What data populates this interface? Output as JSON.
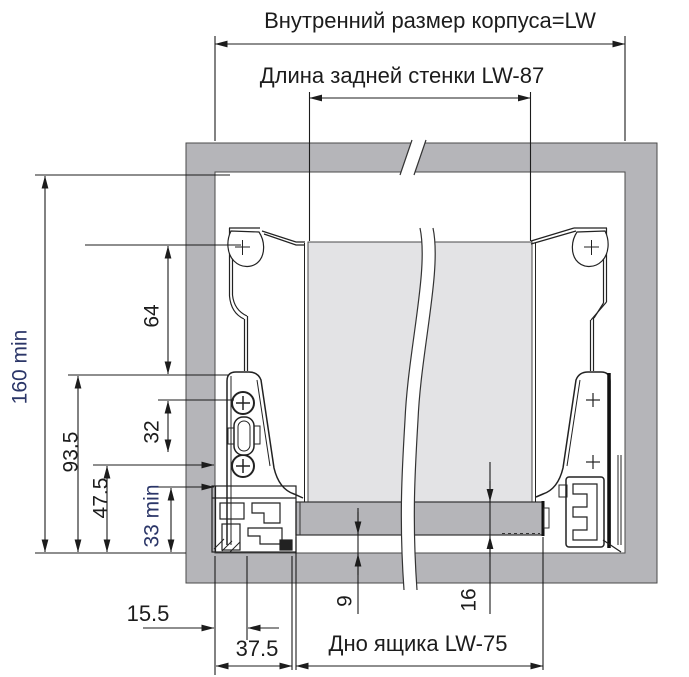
{
  "drawing": {
    "title_labels": {
      "cabinet_inner_width": "Внутренний размер корпуса=LW",
      "back_wall_length": "Длина задней стенки  LW-87",
      "drawer_bottom": "Дно ящика  LW-75"
    },
    "dims": {
      "install_height_min": "160 min",
      "bracket_top_height": "93.5",
      "mid_screw_height": "47.5",
      "bottom_clearance_min": "33 min",
      "hole_to_rail": "64",
      "screw_spacing": "32",
      "wall_to_screw_axis": "15.5",
      "wall_to_panel_edge": "37.5",
      "gap_under_bottom": "9",
      "bottom_panel_thickness": "16"
    },
    "colors": {
      "cabinet_panel_gray": "#b5b5b9",
      "back_panel_gray": "#e3e3e5",
      "line_dark": "#1c1c1c",
      "blue_dim_text": "#2b3668",
      "background": "#ffffff"
    }
  }
}
